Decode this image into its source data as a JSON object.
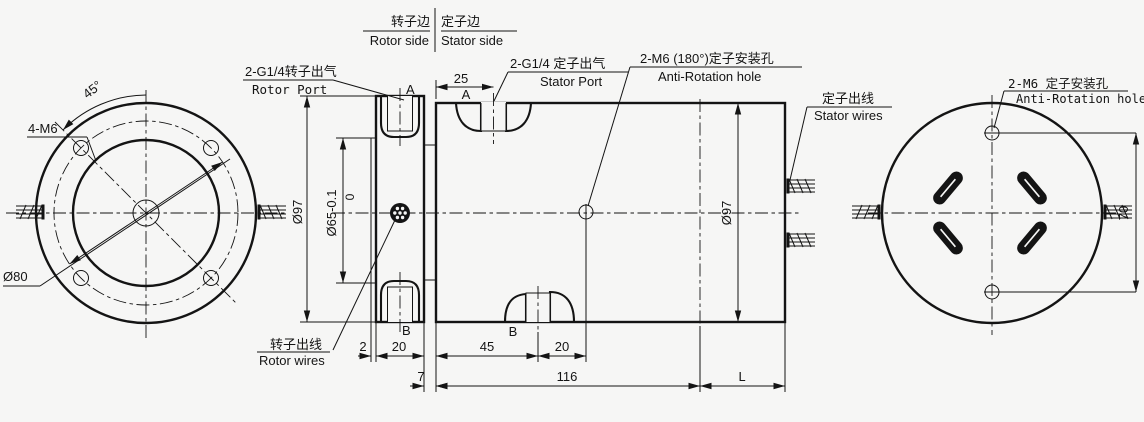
{
  "colors": {
    "line": "#141414",
    "background": "#f6f6f5"
  },
  "header": {
    "rotor_cn": "转子边",
    "rotor_en": "Rotor side",
    "stator_cn": "定子边",
    "stator_en": "Stator side"
  },
  "labels": {
    "rotor_port_cn": "2-G1/4转子出气",
    "rotor_port_en": "Rotor Port",
    "stator_port_cn": "2-G1/4 定子出气",
    "stator_port_en": "Stator Port",
    "anti_rotation_mid_cn": "2-M6 (180°)定子安装孔",
    "anti_rotation_mid_en": "Anti-Rotation hole",
    "stator_wires_cn": "定子出线",
    "stator_wires_en": "Stator wires",
    "rotor_wires_cn": "转子出线",
    "rotor_wires_en": "Rotor wires",
    "anti_rotation_right_cn": "2-M6 定子安装孔",
    "anti_rotation_right_en": "Anti-Rotation hole",
    "bolt_holes": "4-M6"
  },
  "dimensions": {
    "angle": "45°",
    "bolt_circle": "Ø80",
    "flange_dia": "Ø97",
    "bore_tol_upper": "0",
    "bore": "Ø65-0.1",
    "housing_dia": "Ø97",
    "port_offset": "25",
    "boss": "2",
    "flange_w": "20",
    "port_b_offset": "45",
    "hole_offset": "20",
    "gap": "7",
    "housing_len": "116",
    "ext_len": "L",
    "hole_spacing": "70"
  },
  "port_marks": {
    "rotor_a": "A",
    "stator_a": "A",
    "rotor_b": "B",
    "stator_b": "B"
  }
}
